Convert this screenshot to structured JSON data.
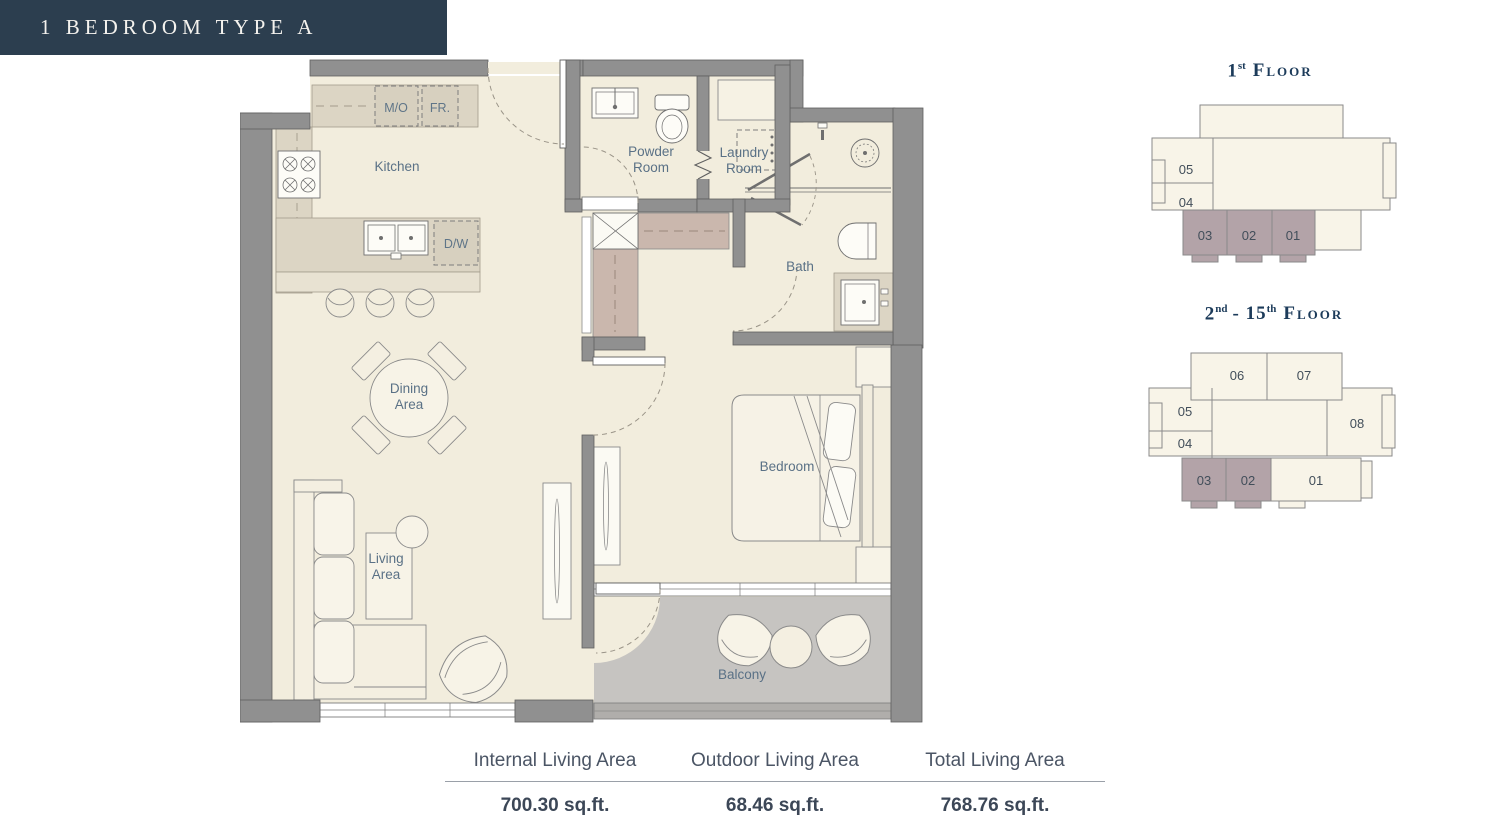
{
  "banner": {
    "title": "1 BEDROOM TYPE A"
  },
  "plan": {
    "rooms": {
      "kitchen": "Kitchen",
      "powder": [
        "Powder",
        "Room"
      ],
      "laundry": [
        "Laundry",
        "Room"
      ],
      "bath": "Bath",
      "bedroom": "Bedroom",
      "dining": [
        "Dining",
        "Area"
      ],
      "living": [
        "Living",
        "Area"
      ],
      "balcony": "Balcony"
    },
    "appliances": {
      "microwave": "M/O",
      "fridge": "FR.",
      "dishwasher": "D/W"
    }
  },
  "floors": [
    {
      "title": {
        "num": "1",
        "sup": "st",
        "word": "Floor"
      },
      "units": [
        "05",
        "04",
        "03",
        "02",
        "01"
      ],
      "highlighted_units": [
        "03",
        "02",
        "01"
      ]
    },
    {
      "title": {
        "num": "2",
        "sup": "nd",
        "mid": "- 15",
        "sup2": "th",
        "word": "Floor"
      },
      "units": [
        "06",
        "07",
        "05",
        "04",
        "08",
        "03",
        "02",
        "01"
      ],
      "highlighted_units": [
        "03",
        "02"
      ]
    }
  ],
  "stats": {
    "columns": [
      {
        "label": "Internal Living Area",
        "value": "700.30 sq.ft."
      },
      {
        "label": "Outdoor Living Area",
        "value": "68.46 sq.ft."
      },
      {
        "label": "Total Living Area",
        "value": "768.76 sq.ft."
      }
    ]
  },
  "colors": {
    "banner_bg": "#2c3e4f",
    "heading": "#1c3b5a",
    "room_label": "#5a7186",
    "wall": "#909090",
    "floor": "#f2eddd",
    "counter": "#dcd5c4",
    "closet": "#cab7ad",
    "balcony_floor": "#c6c4c1",
    "unit_highlight": "#b3a3a8",
    "minimap_floor": "#f8f4e8"
  }
}
